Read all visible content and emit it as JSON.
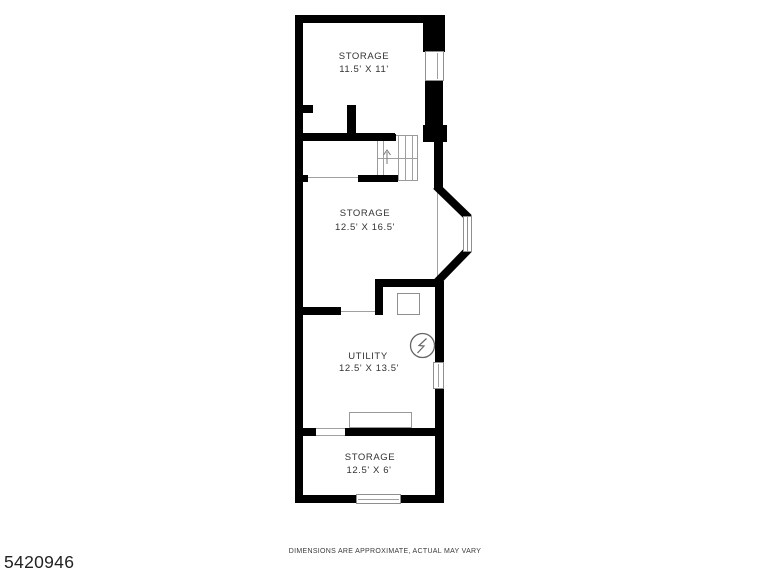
{
  "page": {
    "id_number": "5420946",
    "disclaimer": "DIMENSIONS ARE APPROXIMATE, ACTUAL MAY VARY"
  },
  "floorplan": {
    "rooms": [
      {
        "name": "STORAGE",
        "dims": "11.5' X 11'"
      },
      {
        "name": "STORAGE",
        "dims": "12.5' X 16.5'"
      },
      {
        "name": "UTILITY",
        "dims": "12.5' X 13.5'"
      },
      {
        "name": "STORAGE",
        "dims": "12.5' X 6'"
      }
    ],
    "symbols": [
      "staircase",
      "stair-direction-arrow",
      "furnace-box",
      "electrical-panel",
      "bay-window",
      "window"
    ],
    "colors": {
      "wall": "#000000",
      "thin_line": "#a0a0a0",
      "label_text": "#333333",
      "background": "#ffffff"
    }
  }
}
